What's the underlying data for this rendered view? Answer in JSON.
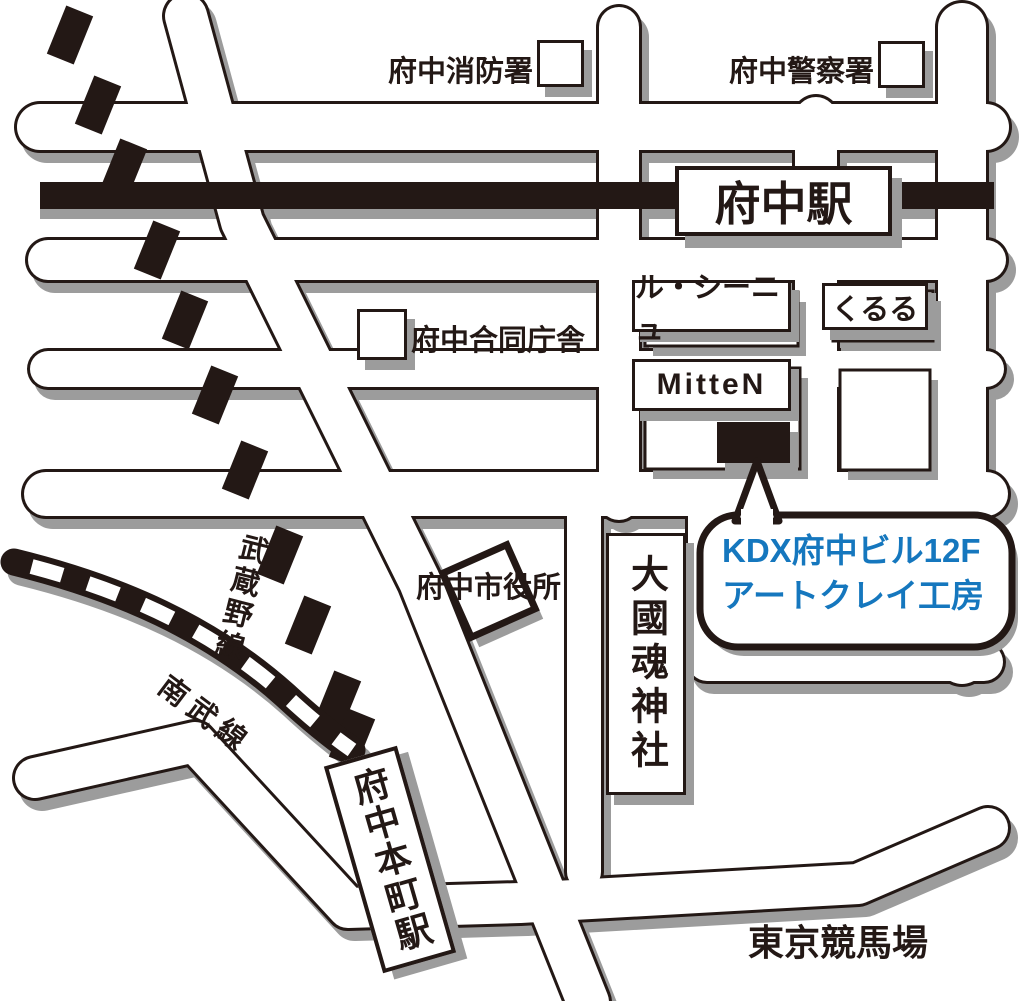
{
  "colors": {
    "ink": "#231815",
    "shadow": "#9c9c9c",
    "accent_blue": "#1577BE",
    "road_fill": "#ffffff"
  },
  "labels": {
    "fire_station": "府中消防署",
    "police_station": "府中警察署",
    "fuchu_station": "府中駅",
    "le_signe": "ル・シーニュ",
    "kururu": "くるる",
    "mitten": "MitteN",
    "joint_gov_building": "府中合同庁舎",
    "city_hall": "府中市役所",
    "okunitama_shrine": "大國魂神社",
    "musashino_line": "武蔵野線",
    "nanbu_line": "南武線",
    "fuchu_honmachi_station": "府中本町駅",
    "tokyo_racecourse": "東京競馬場"
  },
  "callout": {
    "line1": "KDX府中ビル12F",
    "line2": "アートクレイ工房"
  }
}
